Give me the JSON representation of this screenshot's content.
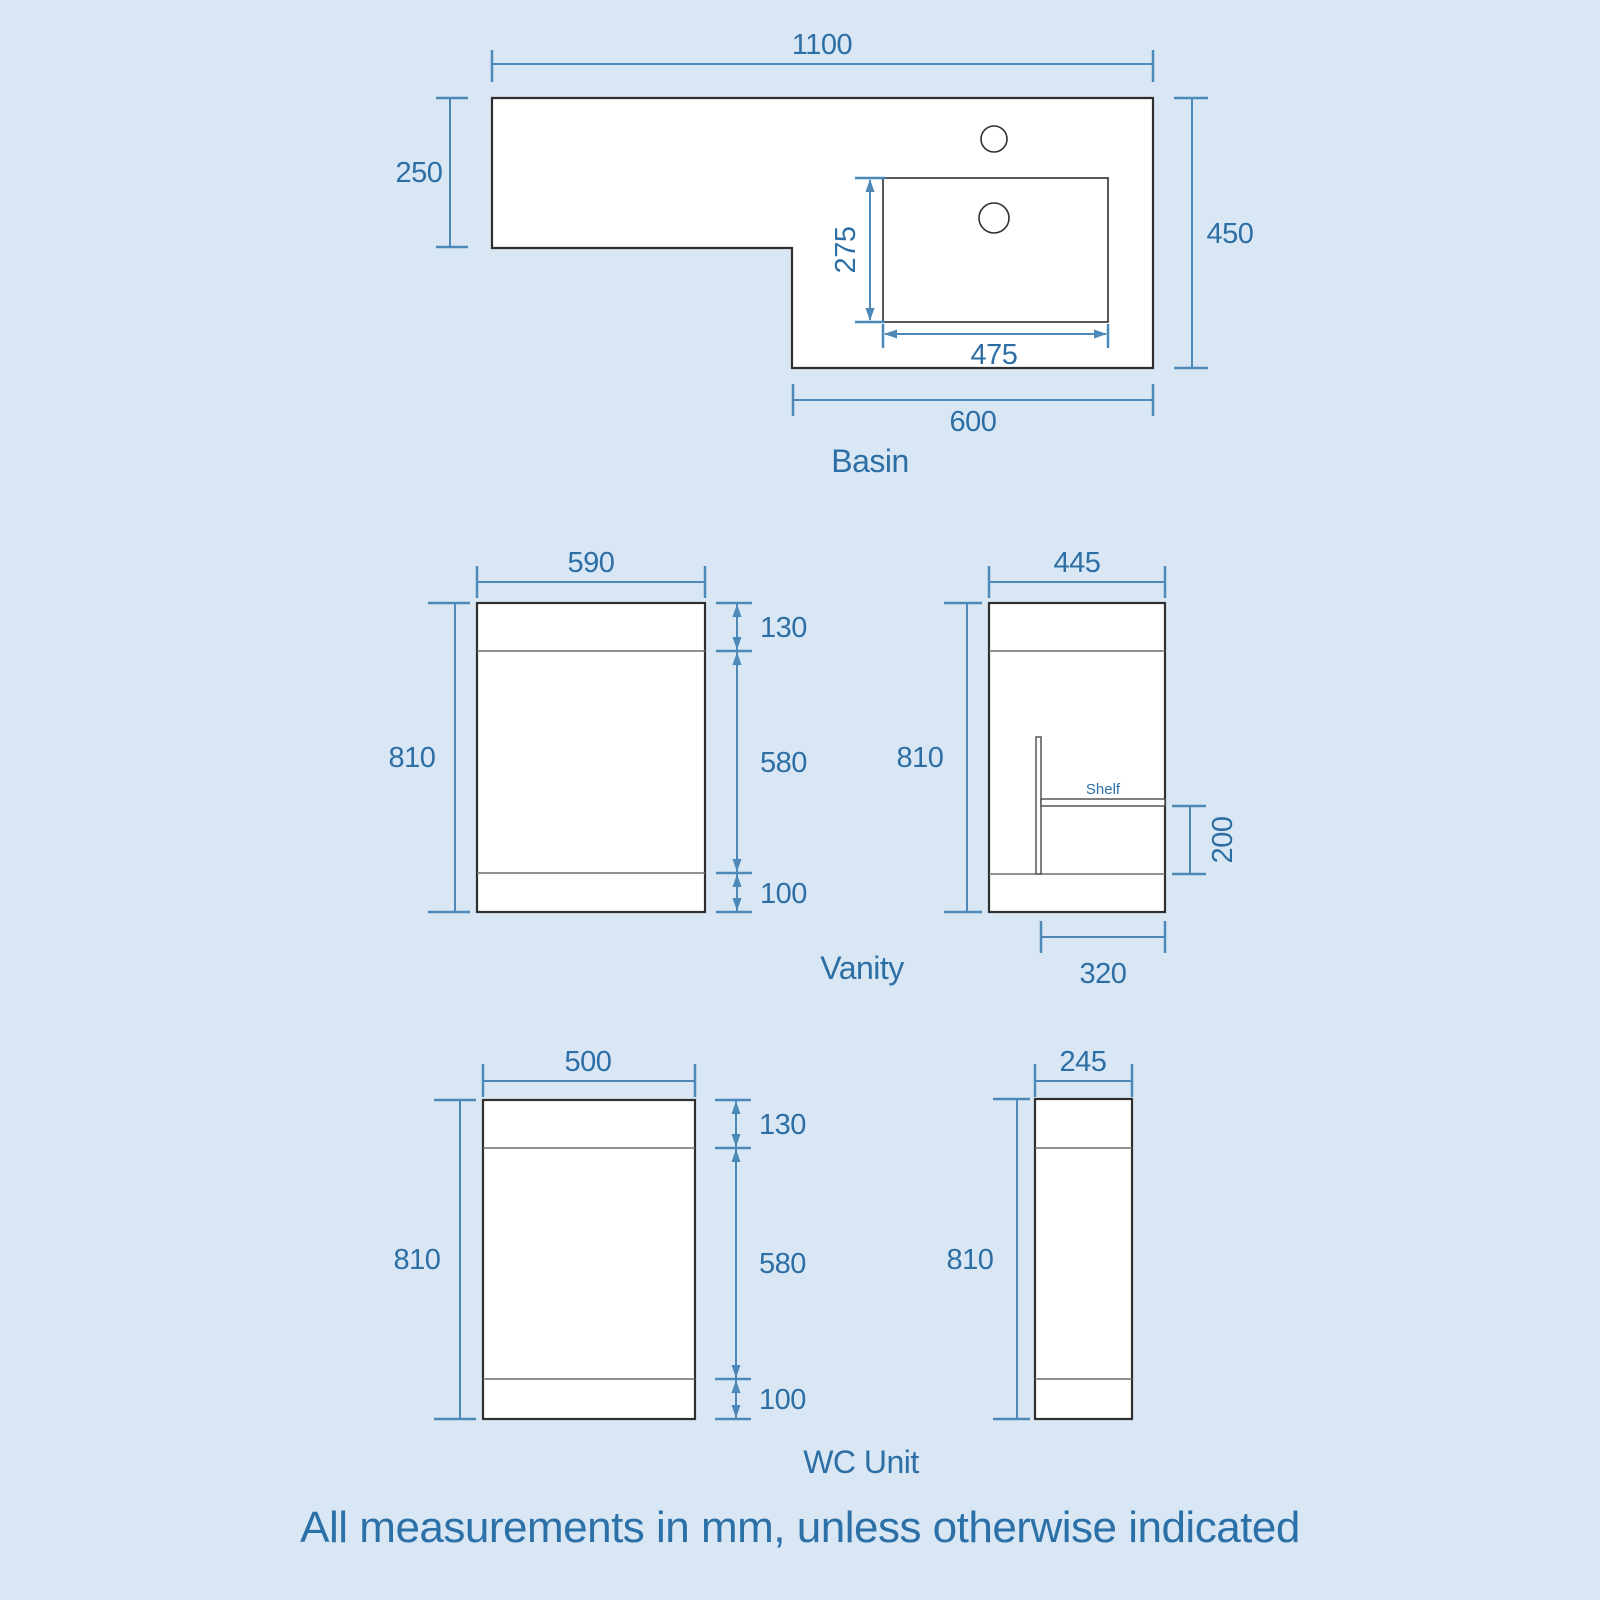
{
  "colors": {
    "background": "#d9e7f5",
    "dimension_line": "#4d89b8",
    "dimension_text": "#2d6fa4",
    "shape_outline": "#2f2f2f",
    "shape_fill": "#ffffff"
  },
  "basin": {
    "label": "Basin",
    "dims": {
      "total_width": "1100",
      "left_depth": "250",
      "right_depth": "450",
      "bowl_depth": "275",
      "bowl_width": "475",
      "right_section_width": "600"
    }
  },
  "vanity": {
    "label": "Vanity",
    "front": {
      "width": "590",
      "height": "810",
      "top_segment": "130",
      "middle_segment": "580",
      "bottom_segment": "100"
    },
    "side": {
      "width": "445",
      "height": "810",
      "shelf_label": "Shelf",
      "shelf_height": "200",
      "shelf_depth": "320"
    }
  },
  "wc": {
    "label": "WC Unit",
    "front": {
      "width": "500",
      "height": "810",
      "top_segment": "130",
      "middle_segment": "580",
      "bottom_segment": "100"
    },
    "side": {
      "width": "245",
      "height": "810"
    }
  },
  "footer": {
    "note": "All measurements in mm, unless otherwise indicated"
  }
}
